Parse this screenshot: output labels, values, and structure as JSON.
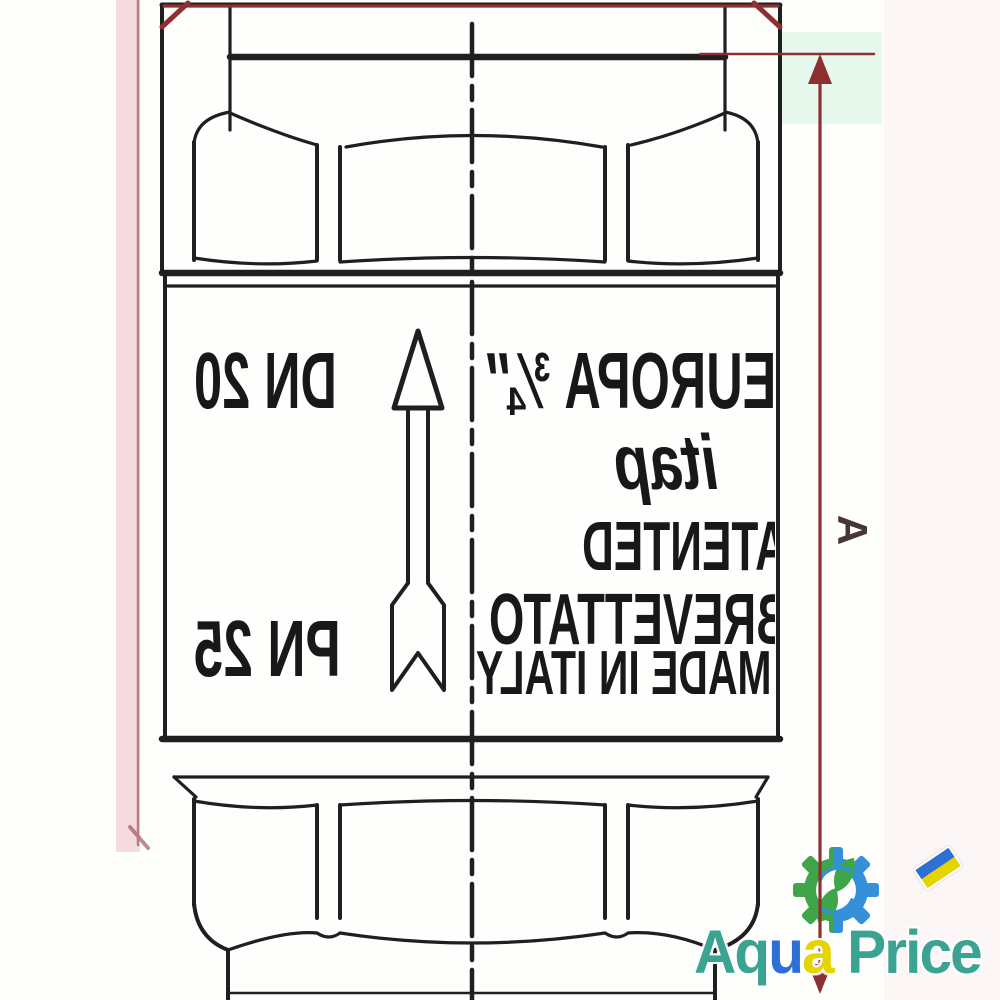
{
  "colors": {
    "ink": "#1f1f1f",
    "dim": "#8e3032",
    "wmTeal": "#3aa392",
    "wmBlue": "#2e6fd6",
    "wmYellow": "#e6d400",
    "gearGreen": "#2f9e3c",
    "gearBlue": "#2487d8"
  },
  "drawing": {
    "type": "check valve technical drawing, markings mirrored (flipped scan)",
    "marks": {
      "size": "EUROPA ¾″",
      "dn": "DN 20",
      "brand": "itap",
      "patented": "PATENTED",
      "brevettato": "BREVETTATO",
      "origin": "MADE IN ITALY",
      "pn": "PN 25"
    },
    "dimension_a_label": "A"
  },
  "watermark": {
    "text": "Aqua Price",
    "segments": [
      {
        "t": "Aq",
        "c": "#3aa392"
      },
      {
        "t": "u",
        "c": "#2e6fd6"
      },
      {
        "t": "a",
        "c": "#e6d400"
      },
      {
        "t": " Pr",
        "c": "#3aa392"
      },
      {
        "t": "i",
        "c": "#3aa392"
      },
      {
        "t": "ce",
        "c": "#3aa392"
      }
    ]
  }
}
